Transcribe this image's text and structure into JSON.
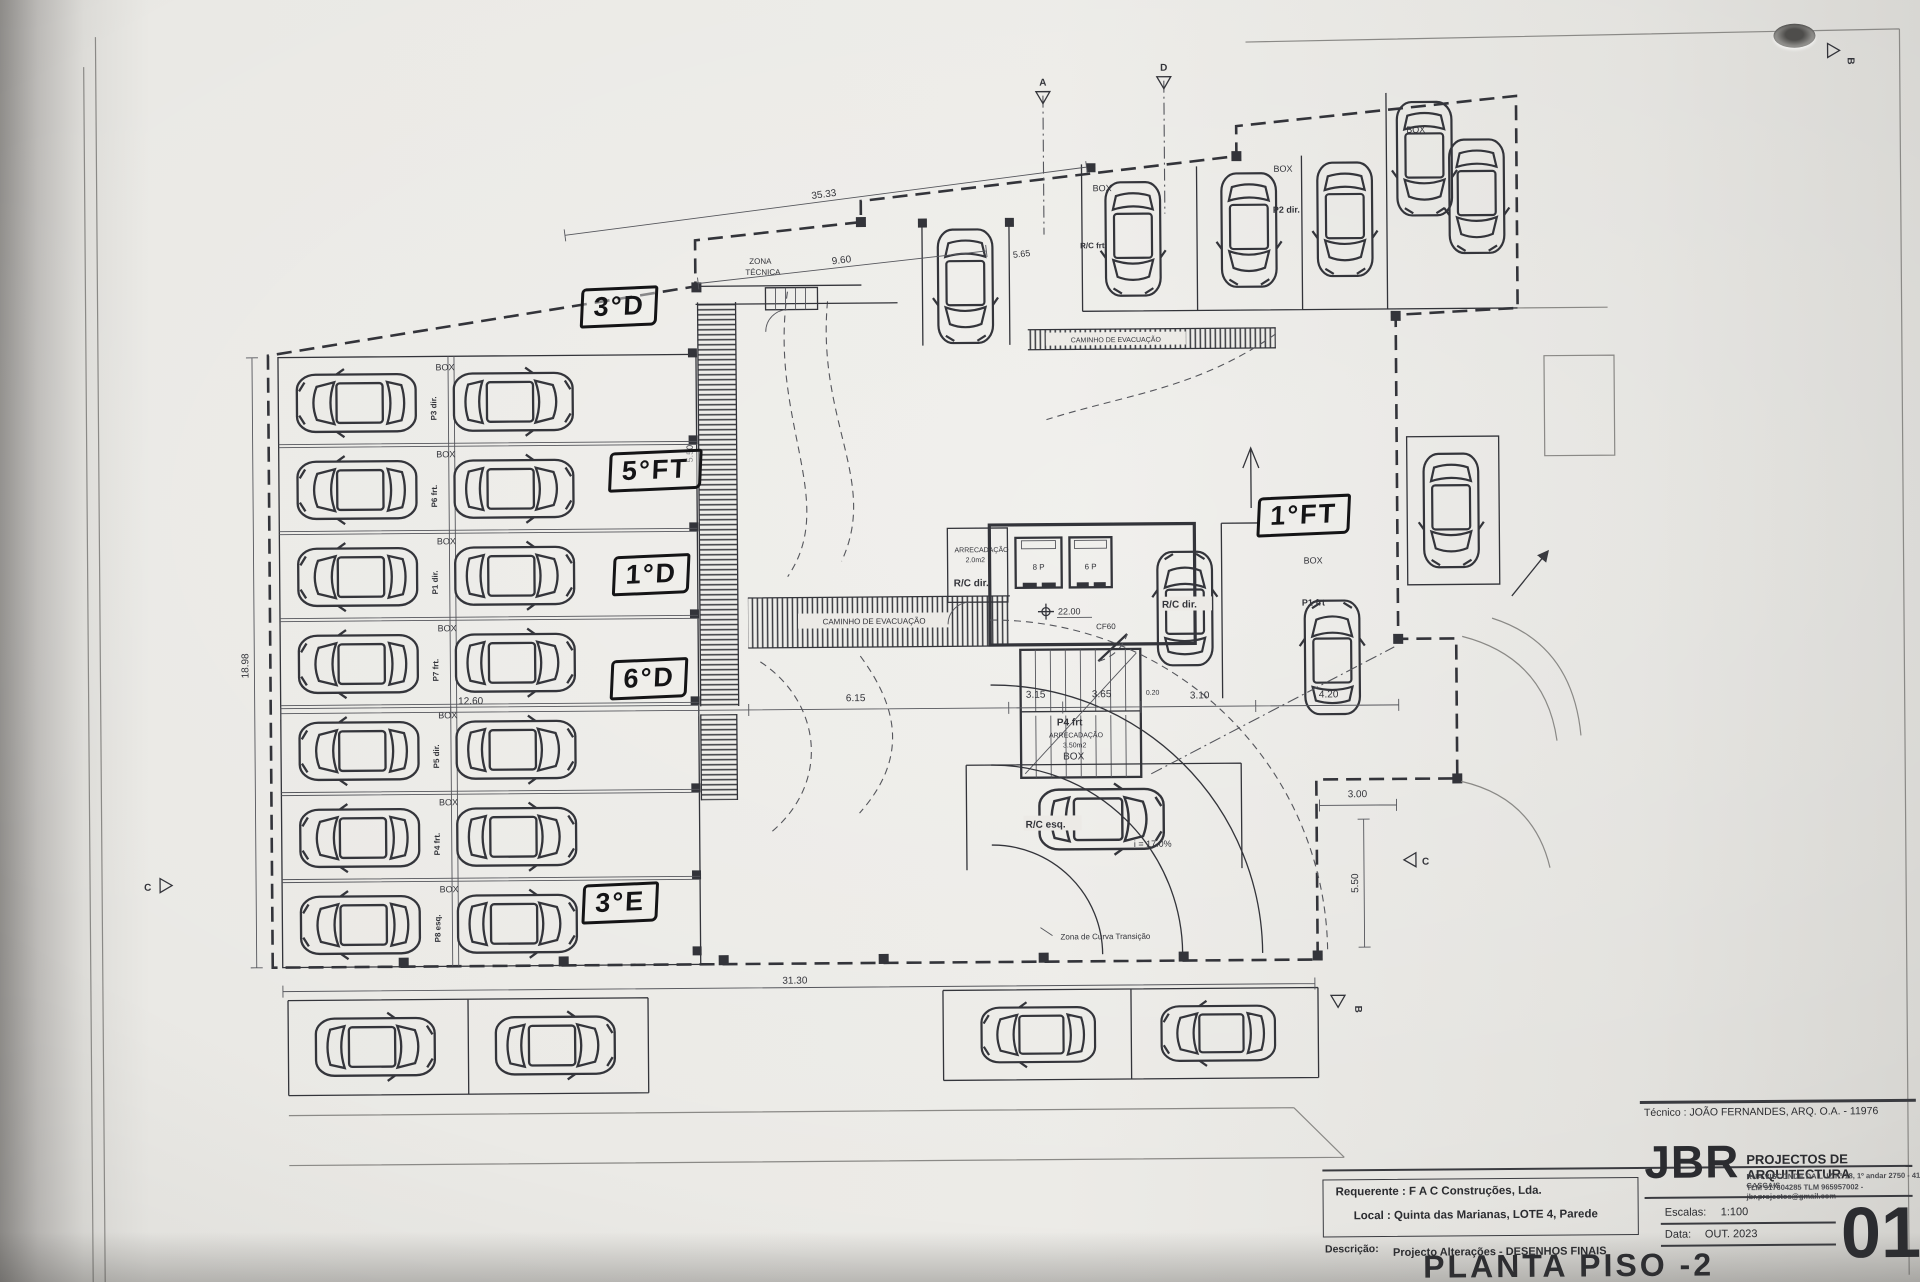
{
  "colors": {
    "paper": "#e8e7e3",
    "ink": "#33343a",
    "marker": "#141416"
  },
  "titleblock": {
    "tecnico": "Técnico : JOÃO FERNANDES, ARQ.   O.A. - 11976",
    "firm_name": "JBR",
    "firm_tagline": "PROJECTOS DE ARQUITECTURA",
    "firm_address": "RUA VISCONDE DA LUZ nº 18, 1º andar  2750 - 416  CASCAIS",
    "firm_contact": "TLM 917604285  TLM 965957002 - jbr.projectos@gmail.com",
    "requerente": "Requerente : F A C  Construções, Lda.",
    "local": "Local : Quinta das Marianas, LOTE 4, Parede",
    "descricao_label": "Descrição:",
    "descricao": "Projecto Alterações - DESENHOS FINAIS",
    "escala_label": "Escalas:",
    "escala_value": "1:100",
    "data_label": "Data:",
    "data_value": "OUT. 2023",
    "title": "PLANTA PISO -2",
    "sheet": "01"
  },
  "handwritten": {
    "labels": [
      "3°D",
      "5°FT",
      "1°D",
      "6°D",
      "3°E",
      "1°FT"
    ]
  },
  "plan": {
    "zona_tecnica_1": "ZONA",
    "zona_tecnica_2": "TÉCNICA",
    "caminho": "CAMINHO DE EVACUAÇÃO",
    "box": "BOX",
    "rc_frt": "R/C frt",
    "rc_dir": "R/C dir.",
    "rc_esq": "R/C esq.",
    "p2_dir": "P2 dir.",
    "p1_frt": "P1 frt",
    "p4_frt": "P4 frt",
    "arrec_small_name": "ARRECADAÇÃO",
    "arrec_small_area": "2.0m2",
    "arrec_big_name": "ARRECADAÇÃO",
    "arrec_big_area": "3.50m2",
    "elev_left": "8 P",
    "elev_right": "6 P",
    "cf60": "CF60",
    "level": "22.00",
    "slope": "i = 17.0%",
    "curva": "Zona de Curva Transição",
    "marker_a": "A",
    "marker_b": "B",
    "marker_c": "C",
    "marker_d": "D"
  },
  "parking": {
    "rows": [
      {
        "code": "P3 dir."
      },
      {
        "code": "P6 frt."
      },
      {
        "code": "P1 dir."
      },
      {
        "code": "P7 frt."
      },
      {
        "code": "P5 dir."
      },
      {
        "code": "P4 frt."
      },
      {
        "code": "P8 esq."
      }
    ]
  },
  "dims": {
    "d3533": "35.33",
    "d960": "9.60",
    "d565": "5.65",
    "d550a": "5.50",
    "d1260": "12.60",
    "d615": "6.15",
    "d315": "3.15",
    "d365": "3.65",
    "d020": "0.20",
    "d310": "3.10",
    "d420": "4.20",
    "d3130": "31.30",
    "d300": "3.00",
    "d550b": "5.50",
    "d1898": "18.98"
  }
}
